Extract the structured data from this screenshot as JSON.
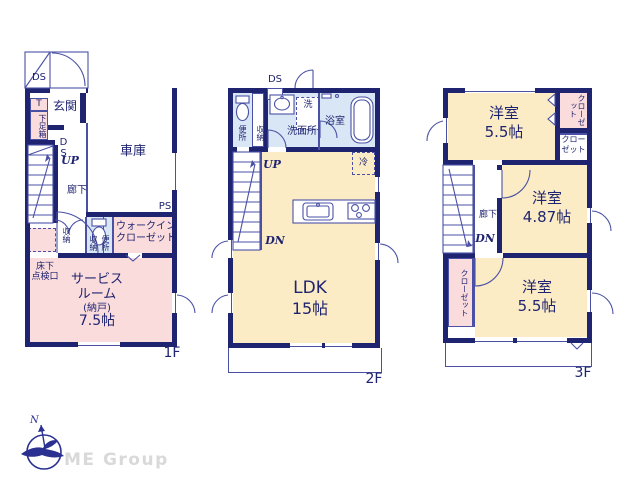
{
  "colors": {
    "wall": "#1f2470",
    "thin_line": "#4a51a5",
    "room_pink": "#fadcdc",
    "room_cream": "#fcecc6",
    "room_blue": "#d8e6f5",
    "logo_navy": "#2b3190",
    "logo_text_gray": "#d9d9d9"
  },
  "floor1": {
    "floor_label": "1F",
    "porch_ds": "DS",
    "entrance": "玄関",
    "t_box": "T",
    "shoe_box": "下足箱",
    "duct": "DS",
    "up": "UP",
    "hallway": "廊下",
    "garage": "車庫",
    "ps": "PS",
    "closet_hall": "収納",
    "closet_side": "収納",
    "toilet": "便所",
    "wic_line1": "ウォークイン",
    "wic_line2": "クローゼット",
    "underfloor_line1": "床下",
    "underfloor_line2": "点検口",
    "service_line1": "サービス",
    "service_line2": "ルーム",
    "service_line3": "(納戸)",
    "service_line4": "7.5帖"
  },
  "floor2": {
    "floor_label": "2F",
    "duct": "DS",
    "toilet": "便所",
    "closet": "収納",
    "washer": "洗",
    "washroom": "洗面所",
    "bathroom": "浴室",
    "up": "UP",
    "down": "DN",
    "fridge": "冷",
    "ldk_line1": "LDK",
    "ldk_line2": "15帖"
  },
  "floor3": {
    "floor_label": "3F",
    "room_top_line1": "洋室",
    "room_top_line2": "5.5帖",
    "closet_top": "クローゼット",
    "closet_mid_line1": "クロー",
    "closet_mid_line2": "ゼット",
    "hallway": "廊下",
    "down": "DN",
    "room_mid_line1": "洋室",
    "room_mid_line2": "4.87帖",
    "closet_left": "クローゼット",
    "room_bottom_line1": "洋室",
    "room_bottom_line2": "5.5帖"
  },
  "logo": {
    "compass_n": "N",
    "company": "ME Group"
  }
}
